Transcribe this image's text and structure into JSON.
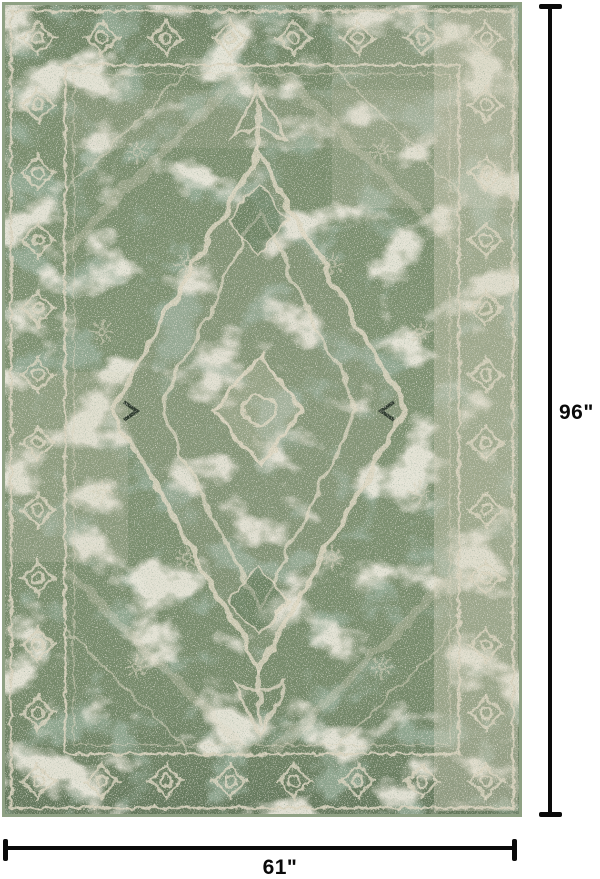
{
  "product_image": {
    "alt": "Distressed vintage oriental area rug in sage green and ivory with central medallion",
    "rug_colors": {
      "field_green": "#7b8e6e",
      "dark_green": "#52684f",
      "cream": "#d8d1bc",
      "edge_sage": "#8fa184"
    }
  },
  "dimensions": {
    "height_label": "96\"",
    "width_label": "61\"",
    "line_color": "#0a0a0a"
  },
  "canvas": {
    "background": "#ffffff"
  }
}
